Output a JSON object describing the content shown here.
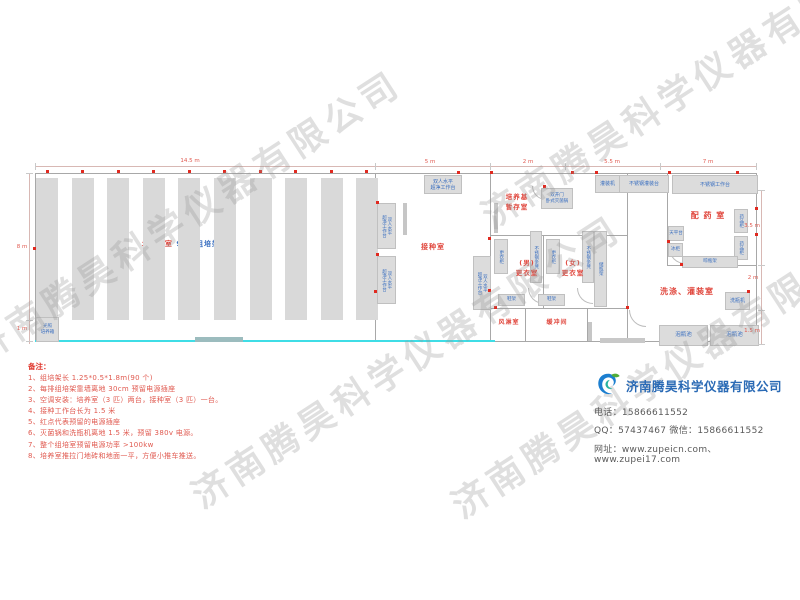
{
  "watermark": {
    "text": "济南腾昊科学仪器有限公司",
    "positions": [
      [
        -40,
        330
      ],
      [
        180,
        475
      ],
      [
        440,
        485
      ],
      [
        470,
        195
      ]
    ]
  },
  "plan": {
    "culture_room": {
      "label_room": "培 养 室",
      "label_racks": "90个组培架",
      "aisle_label": "过道0.6米",
      "rack_count": 10
    },
    "room_labels": [
      {
        "name": "label-inoculation-room",
        "text": "接种室",
        "x": 433,
        "y": 242,
        "fs": 7
      },
      {
        "name": "label-media-storage-room",
        "text": "培养基\n暂存室",
        "x": 517,
        "y": 192,
        "fs": 6.5
      },
      {
        "name": "label-men-changing-room",
        "text": "(男)\n更衣室",
        "x": 527,
        "y": 258,
        "fs": 6.5
      },
      {
        "name": "label-women-changing-room",
        "text": "(女)\n更衣室",
        "x": 573,
        "y": 258,
        "fs": 6.5
      },
      {
        "name": "label-air-shower-room",
        "text": "风淋室",
        "x": 509,
        "y": 318,
        "fs": 6
      },
      {
        "name": "label-buffer-room",
        "text": "缓冲间",
        "x": 557,
        "y": 318,
        "fs": 6
      },
      {
        "name": "label-medicine-prep-room",
        "text": "配 药 室",
        "x": 708,
        "y": 210,
        "fs": 8
      },
      {
        "name": "label-washing-filling-room",
        "text": "洗涤、灌装室",
        "x": 687,
        "y": 286,
        "fs": 8
      }
    ],
    "equipment": [
      {
        "name": "clean-bench-top",
        "label": "双人水平\n超净工作台",
        "x": 424,
        "y": 175,
        "w": 36,
        "h": 17,
        "fs": 5
      },
      {
        "name": "clean-bench-left-1",
        "label": "双人水平\n超净工作台",
        "x": 377,
        "y": 203,
        "w": 17,
        "h": 44,
        "fs": 4.5,
        "vert": true
      },
      {
        "name": "clean-bench-left-2",
        "label": "双人水平\n超净工作台",
        "x": 377,
        "y": 256,
        "w": 17,
        "h": 46,
        "fs": 4.5,
        "vert": true
      },
      {
        "name": "clean-bench-right",
        "label": "双人水平\n超净工作台",
        "x": 473,
        "y": 256,
        "w": 16,
        "h": 52,
        "fs": 4.5,
        "vert": true
      },
      {
        "name": "autoclave",
        "label": "双开门\n卧式灭菌锅",
        "x": 541,
        "y": 188,
        "w": 30,
        "h": 19,
        "fs": 4.5
      },
      {
        "name": "locker-men",
        "label": "更衣柜",
        "x": 494,
        "y": 239,
        "w": 12,
        "h": 33,
        "fs": 4.5,
        "vert": true
      },
      {
        "name": "steel-bench-men",
        "label": "不锈钢条凳",
        "x": 530,
        "y": 231,
        "w": 10,
        "h": 50,
        "fs": 4.5,
        "vert": true
      },
      {
        "name": "locker-women",
        "label": "更衣柜",
        "x": 546,
        "y": 239,
        "w": 12,
        "h": 33,
        "fs": 4.5,
        "vert": true
      },
      {
        "name": "steel-bench-women",
        "label": "不锈钢条凳",
        "x": 582,
        "y": 231,
        "w": 10,
        "h": 50,
        "fs": 4.5,
        "vert": true
      },
      {
        "name": "bottle-storage-rack",
        "label": "储瓶架",
        "x": 594,
        "y": 231,
        "w": 11,
        "h": 74,
        "fs": 4.5,
        "vert": true
      },
      {
        "name": "shoe-rack-1",
        "label": "鞋架",
        "x": 498,
        "y": 294,
        "w": 25,
        "h": 10,
        "fs": 4.5
      },
      {
        "name": "shoe-rack-2",
        "label": "鞋架",
        "x": 538,
        "y": 294,
        "w": 25,
        "h": 10,
        "fs": 4.5
      },
      {
        "name": "filling-machine",
        "label": "灌装机",
        "x": 595,
        "y": 175,
        "w": 23,
        "h": 16,
        "fs": 5
      },
      {
        "name": "steel-filling-table",
        "label": "不锈钢灌装台",
        "x": 619,
        "y": 175,
        "w": 48,
        "h": 16,
        "fs": 5
      },
      {
        "name": "steel-work-table",
        "label": "不锈钢工作台",
        "x": 672,
        "y": 175,
        "w": 84,
        "h": 17,
        "fs": 5
      },
      {
        "name": "balance-table",
        "label": "天平台",
        "x": 668,
        "y": 226,
        "w": 14,
        "h": 13,
        "fs": 4.5
      },
      {
        "name": "freezer",
        "label": "冰柜",
        "x": 668,
        "y": 243,
        "w": 13,
        "h": 12,
        "fs": 4.5
      },
      {
        "name": "medicine-cabinet-1",
        "label": "药品柜",
        "x": 734,
        "y": 209,
        "w": 12,
        "h": 22,
        "fs": 4.5,
        "vert": true
      },
      {
        "name": "medicine-cabinet-2",
        "label": "药品柜",
        "x": 734,
        "y": 236,
        "w": 12,
        "h": 22,
        "fs": 4.5,
        "vert": true
      },
      {
        "name": "bottle-drying-rack",
        "label": "晾瓶架",
        "x": 682,
        "y": 256,
        "w": 54,
        "h": 10,
        "fs": 4.5
      },
      {
        "name": "bottle-washing-machine",
        "label": "洗瓶机",
        "x": 725,
        "y": 292,
        "w": 23,
        "h": 16,
        "fs": 5
      },
      {
        "name": "bottle-soaking-pool-1",
        "label": "泡瓶池",
        "x": 659,
        "y": 325,
        "w": 47,
        "h": 19,
        "fs": 5.5
      },
      {
        "name": "bottle-soaking-pool-2",
        "label": "泡瓶池",
        "x": 710,
        "y": 325,
        "w": 47,
        "h": 19,
        "fs": 5.5
      },
      {
        "name": "light-incubator",
        "label": "光照\n培养箱",
        "x": 36,
        "y": 317,
        "w": 21,
        "h": 23,
        "fs": 4.5
      }
    ],
    "dimensions": [
      {
        "text": "14.5 m",
        "x": 190,
        "y": 158
      },
      {
        "text": "5 m",
        "x": 430,
        "y": 159
      },
      {
        "text": "2 m",
        "x": 528,
        "y": 159
      },
      {
        "text": "5.5 m",
        "x": 612,
        "y": 159
      },
      {
        "text": "7 m",
        "x": 708,
        "y": 159
      },
      {
        "text": "8 m",
        "x": 22,
        "y": 244
      },
      {
        "text": "1 m",
        "x": 22,
        "y": 326
      },
      {
        "text": "3.5 m",
        "x": 752,
        "y": 223
      },
      {
        "text": "2 m",
        "x": 753,
        "y": 275
      },
      {
        "text": "1.5 m",
        "x": 752,
        "y": 328
      }
    ],
    "sockets": [
      [
        46,
        170
      ],
      [
        81,
        170
      ],
      [
        117,
        170
      ],
      [
        152,
        170
      ],
      [
        188,
        170
      ],
      [
        223,
        170
      ],
      [
        259,
        170
      ],
      [
        294,
        170
      ],
      [
        330,
        170
      ],
      [
        365,
        170
      ],
      [
        457,
        171
      ],
      [
        490,
        171
      ],
      [
        543,
        185
      ],
      [
        571,
        171
      ],
      [
        595,
        171
      ],
      [
        668,
        171
      ],
      [
        736,
        171
      ],
      [
        376,
        201
      ],
      [
        376,
        253
      ],
      [
        488,
        237
      ],
      [
        488,
        289
      ],
      [
        667,
        240
      ],
      [
        755,
        207
      ],
      [
        755,
        233
      ],
      [
        747,
        290
      ],
      [
        680,
        263
      ],
      [
        626,
        306
      ],
      [
        494,
        306
      ],
      [
        33,
        247
      ],
      [
        374,
        290
      ]
    ]
  },
  "notes": {
    "title": "备注：",
    "items": [
      "1、组培架长 1.25*0.5*1.8m(90 个)",
      "2、每排组培架靠墙离地 30cm 预留电源插座",
      "3、空调安装：培养室（3 匹）两台，接种室（3 匹）一台。",
      "4、接种工作台长为 1.5 米",
      "5、红点代表预留的电源插座",
      "6、灭菌锅和洗瓶机离地 1.5 米，预留 380v 电源。",
      "7、整个组培室预留电源功率 >100kw",
      "8、培养室推拉门地砖和地面一平，方便小推车推送。"
    ]
  },
  "company": {
    "name": "济南腾昊科学仪器有限公司",
    "phone": "电话：15866611552",
    "qq_wechat": "QQ：57437467   微信：15866611552",
    "website": "网址：www.zupeicn.com、 www.zupei17.com"
  }
}
